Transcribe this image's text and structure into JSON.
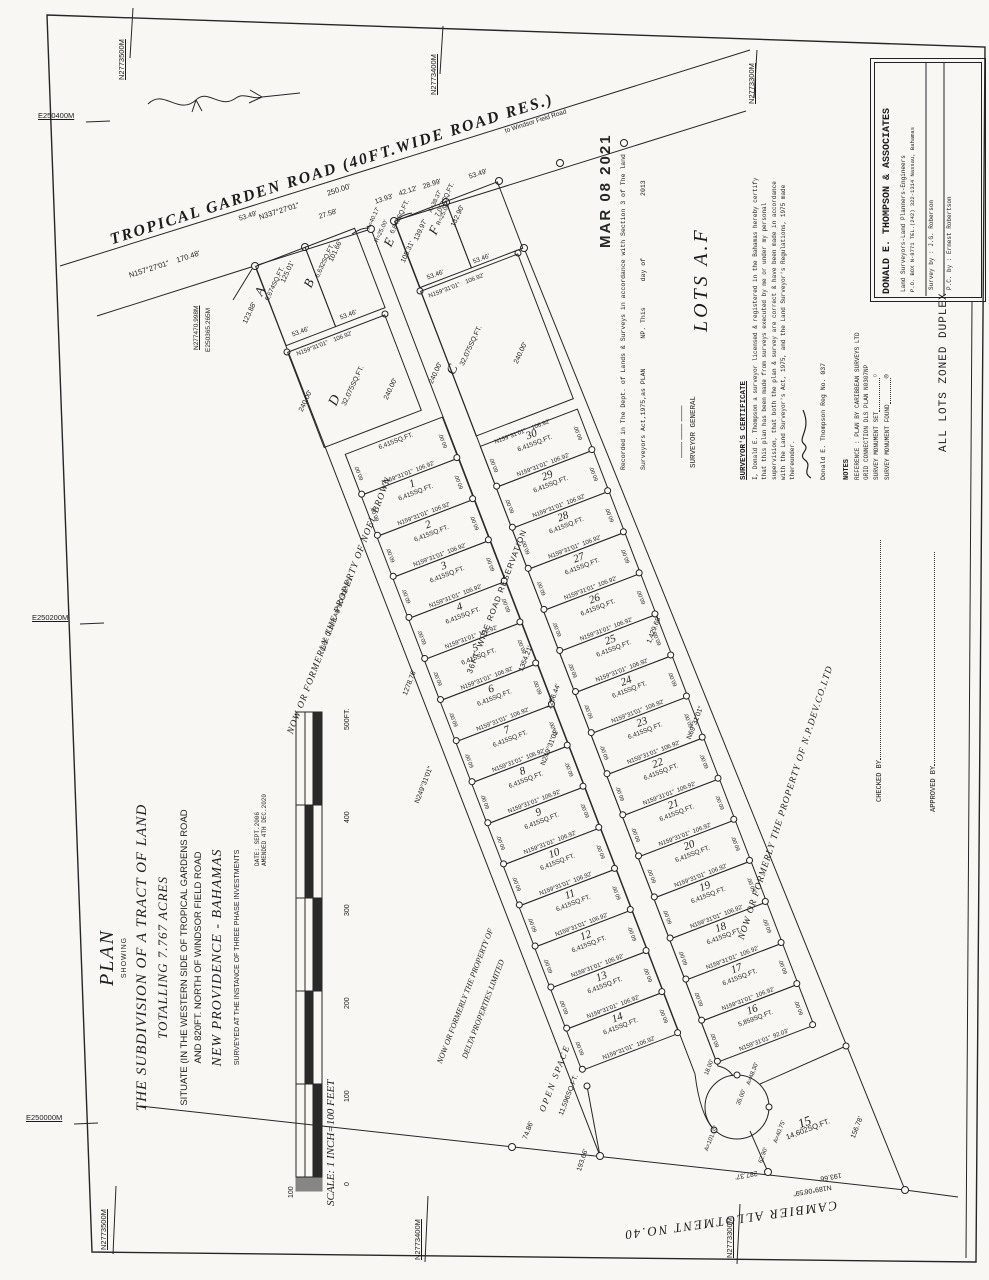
{
  "page": {
    "stamp": "MAR 08 2021",
    "handwritten": "LOTS A.F"
  },
  "grid": {
    "top": [
      "N2773500M",
      "N2773400M",
      "N2773300M"
    ],
    "bottom": [
      "N2773500M",
      "N2773400M",
      "N2773300M"
    ],
    "left": [
      "E250400M",
      "E250200M",
      "E250000M"
    ]
  },
  "title_block": {
    "heading": "PLAN",
    "sub": "SHOWING",
    "line1": "THE SUBDIVISION OF A TRACT OF LAND",
    "line2": "TOTALLING 7.767 ACRES",
    "line3": "SITUATE (IN THE WESTERN SIDE OF TROPICAL GARDENS ROAD",
    "line4": "AND 820FT. NORTH OF WINDSOR FIELD ROAD",
    "line5": "NEW PROVIDENCE - BAHAMAS",
    "line6": "SURVEYED AT THE INSTANCE OF THREE PHASE INVESTMENTS",
    "date1": "DATE: SEPT.2006",
    "date2": "AMENDED 4TH DEC.2020"
  },
  "scale": {
    "text": "SCALE: 1 INCH=100 FEET",
    "ticks": [
      "500FT.",
      "400",
      "300",
      "200",
      "100",
      "0",
      "100"
    ]
  },
  "road": {
    "name": "TROPICAL GARDEN ROAD (40FT.WIDE ROAD RES.)",
    "to": "to Windsor Field Road",
    "bearing_left": "N157°27'01\"",
    "len_left": "170.48'",
    "bearing_main": "N337°27'01\"",
    "len_main": "250.00'",
    "segs": [
      "53.49'",
      "27.58'",
      "13.93'",
      "42.12'",
      "28.99'",
      "53.49'"
    ]
  },
  "corner": {
    "n": "N277470.998M",
    "e": "E250365.265M"
  },
  "letter_lots": {
    "A": {
      "id": "A",
      "area": "6,674SQ.FT.",
      "depth": "125.01'"
    },
    "B": {
      "id": "B",
      "area": "6,632SQ.FT.",
      "depth": "101.66'",
      "arc": "A=40.17'",
      "rad": "R=25.00'"
    },
    "E": {
      "id": "E",
      "area": "6,842SQ.FT.",
      "depth": "139.97'",
      "side": "105.31'",
      "arc": "A=38.37'",
      "rad": "R=25.00'"
    },
    "F": {
      "id": "F",
      "area": "7,053SQ.FT.",
      "depth": "132.90'"
    },
    "D": {
      "id": "D",
      "area": "32,075SQ.FT.",
      "depth_l": "240.00'",
      "depth_r": "240.00'"
    },
    "C": {
      "id": "C",
      "area": "32,075SQ.FT.",
      "depth_l": "240.00'",
      "depth_r": "240.00'"
    },
    "ab_bottom": {
      "w1": "53.46'",
      "w2": "53.46'",
      "bearing": "N159°31'01\"",
      "len": "106.92'"
    },
    "ef_bottom": {
      "w1": "53.46'",
      "w2": "53.46'",
      "bearing": "N159°31'01\"",
      "len": "106.92'"
    },
    "boundary_seg": "123.88'"
  },
  "lot_grid": {
    "std_area": "6,415SQ.FT.",
    "std_bearing": "N159°31'01\"",
    "std_len": "106.92'",
    "std_side": "60.00'",
    "left_rows": [
      "",
      "1",
      "2",
      "3",
      "4",
      "5",
      "6",
      "7",
      "8",
      "9",
      "10",
      "11",
      "12",
      "13",
      "14"
    ],
    "right_rows": [
      "30",
      "29",
      "28",
      "27",
      "26",
      "25",
      "24",
      "23",
      "22",
      "21",
      "20",
      "19",
      "18",
      "17"
    ],
    "lot16": {
      "num": "16",
      "area": "5,859SQ.FT.",
      "bearing": "N159°31'01\"",
      "len": "92.03'",
      "arc": "A=48.30'",
      "side": "18.00'"
    }
  },
  "road_res": {
    "label": "36FT. WIDE ROAD RESERVATION",
    "len1": "1354.21'",
    "len2": "1256.44'",
    "bearing": "N249°31'01\""
  },
  "culdesac": {
    "radius": "35.00'",
    "arc": "A=101.05'"
  },
  "lot15": {
    "num": "15",
    "area": "14,602SQ.FT.",
    "side_r": "156.78'",
    "side_l": "62.90'",
    "arc": "A=40.75'"
  },
  "open_space": {
    "name": "OPEN SPACE",
    "area": "11,596SQ.FT.",
    "s1": "193.66'",
    "s2": "74.86'"
  },
  "boundaries": {
    "left_len": "1278.76'",
    "left_bearing": "N249°31'01\"",
    "right_len": "1,429.68'",
    "right_bearing": "N69°31'01\"",
    "bottom_bearing": "N189°06'59\"",
    "bottom_s1": "287.37'",
    "bottom_s2": "193.66'",
    "cambier": "CAMBIER ALLOTMENT NO.40"
  },
  "adjoiners": {
    "noel1": "NOW OR FORMERLY THE PROPERTY OF NOEL BROWN",
    "noel2": "(SEE DLS PLAN NO.301NP)",
    "delta1": "NOW OR FORMERLY THE PROPERTY OF",
    "delta2": "DELTA PROPERTIES LIMITED",
    "npdev": "NOW OR FORMERLY THE PROPERTY OF N.P.DEV.CO.LTD"
  },
  "recorded": {
    "line1": "Recorded in The Dept. of Lands & Surveys in accordance with Section 3 of The land",
    "line2": "Surveyors Act,1975,as PLAN",
    "line2b": "NP.  This",
    "line2c": "day of",
    "line2d": "2013",
    "sig_dashes": "——  ——  ——",
    "official": "SURVEYOR GENERAL"
  },
  "certificate": {
    "heading": "SURVEYOR'S CERTIFICATE",
    "body": "I, Donald E. Thompson a surveyor licensed & registered in the Bahamas hereby certify that this plan has been made from surveys executed by me or under my personal supervision, that both the plan & survey are correct & have been made in accordance with the Land Surveyor's Act, 1975, and the Land Surveyor's Regulations, 1975 made thereunder.",
    "signer": "Donald E. Thompson Reg No. 037"
  },
  "notes": {
    "heading": "NOTES",
    "ref": "REFERENCE : PLAN BY CARIBBEAN SURVEYS LTD",
    "grid_conn": "GRID CONNECTION DLS PLAN N0307NP",
    "mon_set": "SURVEY MONUMENT SET",
    "mon_found": "SURVEY MONUMENT FOUND",
    "symbols": {
      "set": "○",
      "found": "◎"
    },
    "zoning": "ALL LOTS ZONED DUPLEX"
  },
  "approvals": {
    "checked": "CHECKED BY",
    "approved": "APPROVED BY"
  },
  "firm": {
    "name": "DONALD E. THOMPSON & ASSOCIATES",
    "line2": "Land Surveyors-Land Planners-Engineers",
    "line3": "P.O. BOX N-8771 TEL.(242) 322-1314 Nassau, Bahamas",
    "survey_by": "Survey by : J.G. Roberson",
    "pc_by": "P.C. by : Ernest Robertson"
  }
}
